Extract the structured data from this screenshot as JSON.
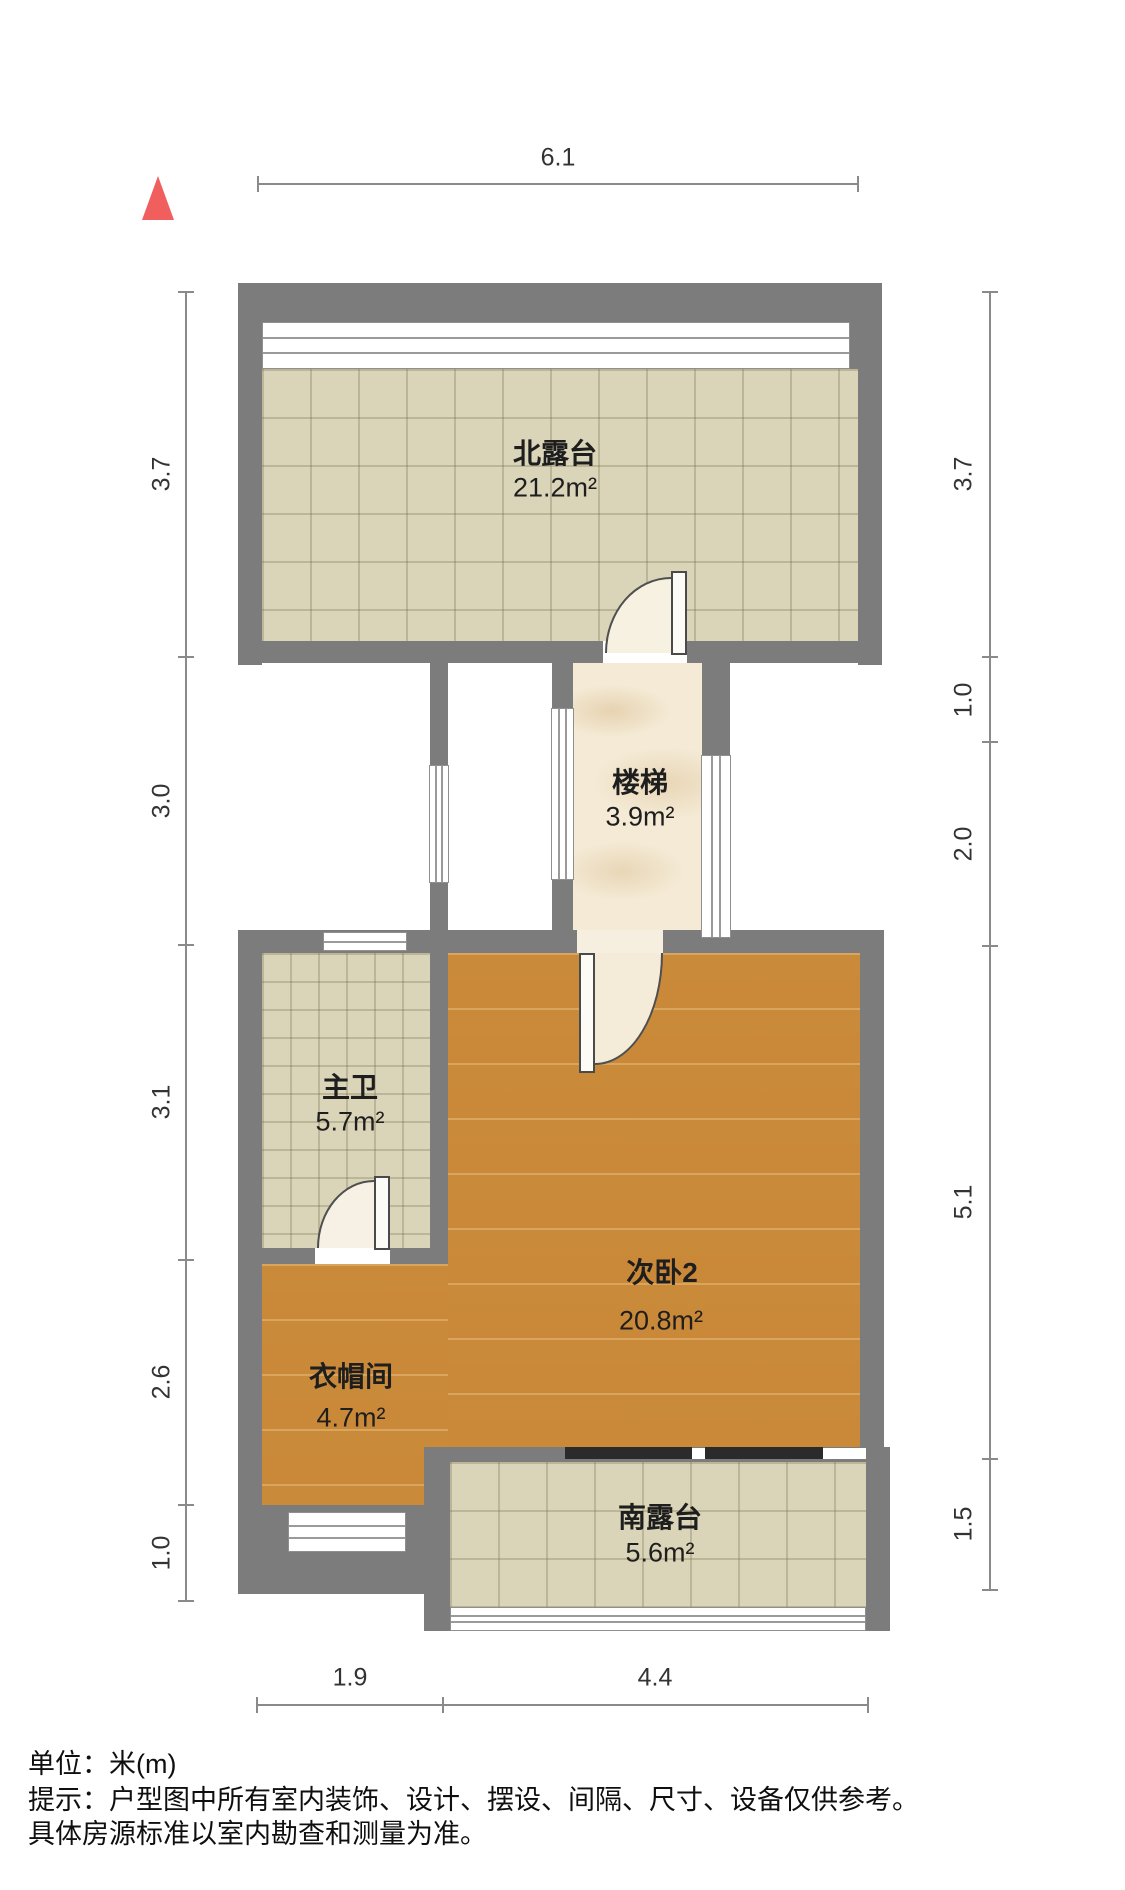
{
  "compass": {
    "symbol": "north-arrow",
    "color": "#f15e5e"
  },
  "rooms": [
    {
      "id": "north-terrace",
      "name": "北露台",
      "area": "21.2m²",
      "floor": "tile"
    },
    {
      "id": "stairs",
      "name": "楼梯",
      "area": "3.9m²",
      "floor": "marble"
    },
    {
      "id": "master-bath",
      "name": "主卫",
      "area": "5.7m²",
      "floor": "tile"
    },
    {
      "id": "bedroom2",
      "name": "次卧2",
      "area": "20.8m²",
      "floor": "wood"
    },
    {
      "id": "cloakroom",
      "name": "衣帽间",
      "area": "4.7m²",
      "floor": "wood"
    },
    {
      "id": "south-terrace",
      "name": "南露台",
      "area": "5.6m²",
      "floor": "tile"
    }
  ],
  "dims": {
    "top": [
      "6.1"
    ],
    "left": [
      "3.7",
      "3.0",
      "3.1",
      "2.6",
      "1.0"
    ],
    "right": [
      "3.7",
      "1.0",
      "2.0",
      "5.1",
      "1.5"
    ],
    "bottom": [
      "1.9",
      "4.4"
    ]
  },
  "footer": {
    "unit_line": "单位：米(m)",
    "tip_line1": "提示：户型图中所有室内装饰、设计、摆设、间隔、尺寸、设备仅供参考。",
    "tip_line2": "具体房源标准以室内勘查和测量为准。"
  },
  "colors": {
    "wall": "#7c7c7c",
    "tile": "#dad4b8",
    "marble": "#f4ead5",
    "wood": "#d29240",
    "rail": "#2b2b2b",
    "north": "#f15e5e"
  }
}
